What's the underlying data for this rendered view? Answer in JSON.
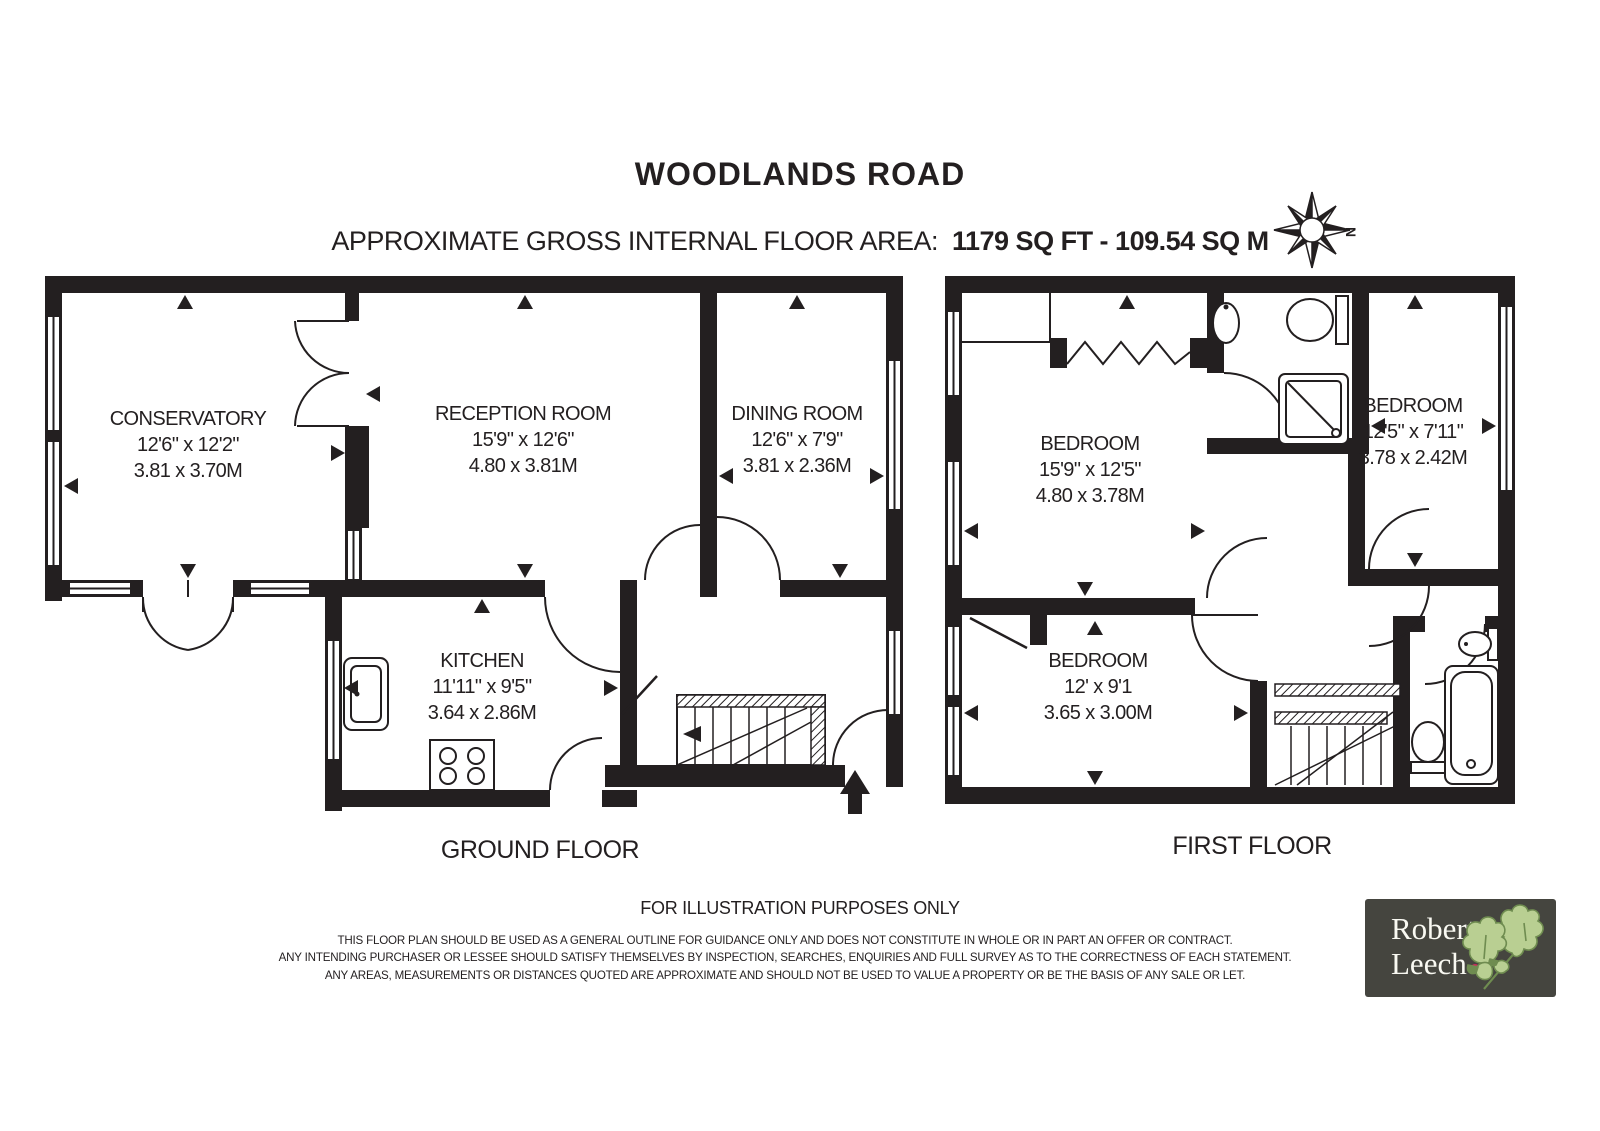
{
  "header": {
    "title": "WOODLANDS ROAD",
    "area_label": "APPROXIMATE GROSS INTERNAL FLOOR AREA:",
    "area_value": "1179 SQ FT  - 109.54 SQ M",
    "compass_direction": "N"
  },
  "ground_floor": {
    "label": "GROUND FLOOR",
    "rooms": {
      "conservatory": {
        "name": "CONSERVATORY",
        "imperial": "12'6\" x 12'2\"",
        "metric": "3.81 x 3.70M"
      },
      "reception": {
        "name": "RECEPTION ROOM",
        "imperial": "15'9\" x 12'6\"",
        "metric": "4.80 x 3.81M"
      },
      "dining": {
        "name": "DINING ROOM",
        "imperial": "12'6\" x 7'9\"",
        "metric": "3.81 x 2.36M"
      },
      "kitchen": {
        "name": "KITCHEN",
        "imperial": "11'11\" x 9'5\"",
        "metric": "3.64 x 2.86M"
      }
    }
  },
  "first_floor": {
    "label": "FIRST FLOOR",
    "rooms": {
      "bedroom1": {
        "name": "BEDROOM",
        "imperial": "15'9\" x 12'5\"",
        "metric": "4.80 x 3.78M"
      },
      "bedroom2": {
        "name": "BEDROOM",
        "imperial": "12'5\" x 7'11\"",
        "metric": "3.78 x 2.42M"
      },
      "bedroom3": {
        "name": "BEDROOM",
        "imperial": "12' x 9'1",
        "metric": "3.65 x 3.00M"
      }
    }
  },
  "footer": {
    "illustration_note": "FOR ILLUSTRATION PURPOSES ONLY",
    "disclaimer_lines": [
      "THIS FLOOR PLAN SHOULD BE USED AS A GENERAL OUTLINE FOR GUIDANCE ONLY AND DOES NOT CONSTITUTE IN WHOLE OR IN PART AN OFFER OR CONTRACT.",
      "ANY INTENDING PURCHASER OR LESSEE SHOULD SATISFY THEMSELVES BY INSPECTION, SEARCHES, ENQUIRIES AND FULL SURVEY AS TO THE CORRECTNESS OF EACH STATEMENT.",
      "ANY AREAS, MEASUREMENTS OR DISTANCES QUOTED ARE APPROXIMATE AND SHOULD NOT BE USED TO VALUE A PROPERTY OR BE THE BASIS OF ANY SALE OR LET."
    ]
  },
  "logo": {
    "line1": "Robert",
    "line2": "Leech"
  },
  "colors": {
    "wall": "#231f20",
    "logo_background": "#45453f",
    "logo_text": "#f9f9f2",
    "logo_dot": "#cf2b5c",
    "leaf_green": "#b9cf92",
    "leaf_outline": "#6f8c50"
  }
}
